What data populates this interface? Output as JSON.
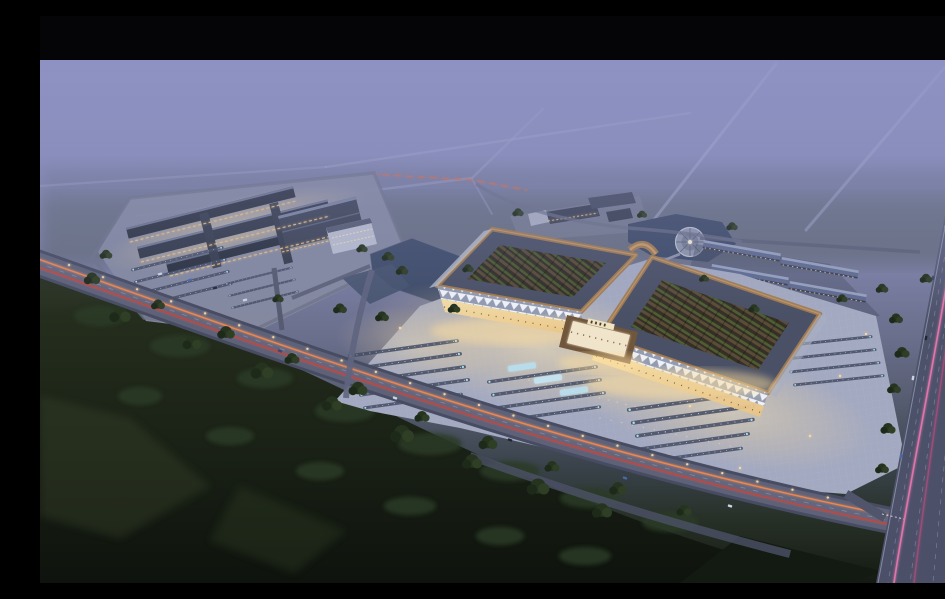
{
  "meta": {
    "type": "architectural-aerial-rendering",
    "time_of_day": "dusk",
    "visible_text": "none",
    "description": "Dusk aerial perspective rendering of a large trade-market campus: two grand halls with upturned copper-edged roofs and planted lattice courtyard roofs over a warmly lit forecourt plaza with parking rows; a secondary market complex with dark strip roofs to the west; dormitory rows, ponds and a circular fountain plaza to the north-east; a foggy lavender horizon with faint country roads; a multi-lane highway with pink light trails on the right; dark woodland with an orange-lit diagonal road across the foreground."
  },
  "palette": {
    "letterbox": "#050507",
    "sky_top": "#8f93c4",
    "sky_mid": "#7c80a5",
    "sky_low": "#555b6e",
    "ground_dusk": "#273026",
    "forest_deep": "#10150e",
    "water": "#3f4c69",
    "roof_copper": "#a07b52",
    "roof_slate": "#4a5166",
    "dorm_roof": "#5f6c90",
    "facade_glow": "#f7e0a6",
    "plaza_base": "#a3a9c0",
    "trail_orange": "#ff8a4a",
    "trail_red": "#d8402e",
    "trail_pink": "#f07ab2",
    "trail_pink_dim": "#aa4e7c",
    "lane_marking": "#9aa0b8",
    "lamp_warm": "#ffd9a2",
    "parking_accent": "#a8dff0",
    "tree_green": "#2c3a25",
    "fog": "#8d91c2"
  },
  "scene": {
    "regions": [
      {
        "id": "letterbox-top",
        "label": "black letterbox bar"
      },
      {
        "id": "fog-sky",
        "label": "lavender dusk fog with faint rural roads"
      },
      {
        "id": "west-complex",
        "label": "secondary market complex with dark strip roofs and parking"
      },
      {
        "id": "center-pond",
        "label": "pond between complexes with white office building"
      },
      {
        "id": "north-pond",
        "label": "pond with circular fountain plaza"
      },
      {
        "id": "dorm-rows",
        "label": "rows of dormitory buildings with slate-blue roofs"
      },
      {
        "id": "main-halls",
        "label": "two grand market halls with copper curved roofs and planted courtyards"
      },
      {
        "id": "entry-gate",
        "label": "glowing central entrance gate"
      },
      {
        "id": "plaza",
        "label": "lit forecourt plaza with parking rows"
      },
      {
        "id": "front-road",
        "label": "diagonal avenue with orange light trails"
      },
      {
        "id": "highway",
        "label": "multi-lane highway with pink light trails"
      },
      {
        "id": "forest",
        "label": "dark foreground woodland"
      }
    ]
  }
}
